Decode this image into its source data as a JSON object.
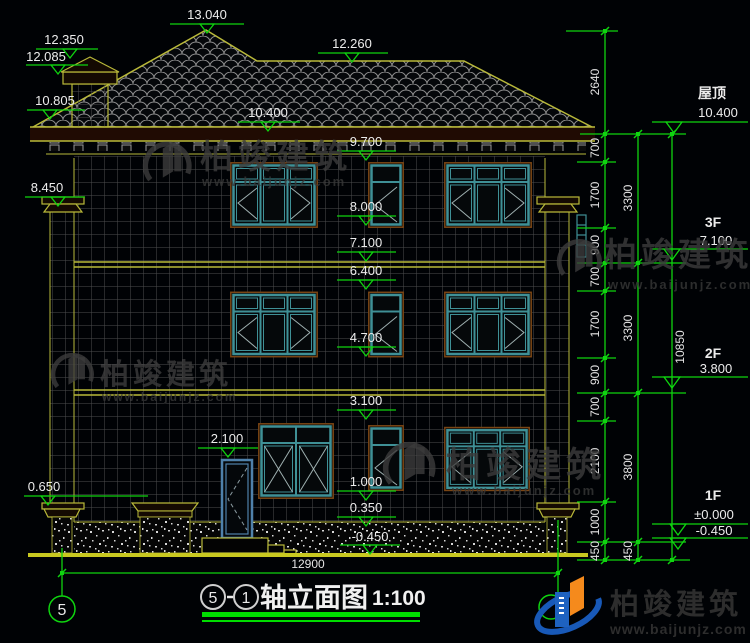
{
  "drawing": {
    "levels": {
      "ridge": "13.040",
      "chimney_top": "12.350",
      "chimney_band": "12.085",
      "roof_right": "12.260",
      "eave_left": "10.805",
      "eave": "10.400",
      "w3_head": "9.700",
      "pilaster_cap": "8.450",
      "w3_sill": "8.000",
      "f3": "7.100",
      "w2_head": "6.400",
      "w2_sill": "4.700",
      "w1_head": "3.100",
      "door_head": "2.100",
      "w1_sill": "1.000",
      "base_left": "0.650",
      "plinth_top": "0.350",
      "ground": "-0.450"
    },
    "right_markers": {
      "roof_label": "屋顶",
      "roof_value": "10.400",
      "f3_label": "3F",
      "f3_value": "7.100",
      "f2_label": "2F",
      "f2_value": "3.800",
      "f1_label": "1F",
      "f1_value": "±0.000",
      "ground_value": "-0.450"
    },
    "dims": {
      "right_inner": [
        "2640",
        "700",
        "1700",
        "900",
        "700",
        "1700",
        "900",
        "700",
        "2100",
        "1000",
        "450"
      ],
      "right_outer": [
        "3300",
        "3300",
        "3800",
        "450"
      ],
      "right_total": "10850",
      "overall_width": "12900"
    },
    "axes": {
      "left": "5",
      "right": "1"
    },
    "title": {
      "axis_start": "5",
      "axis_end": "1",
      "name": "轴立面图",
      "scale": "1:100"
    }
  },
  "watermark": {
    "name": "柏竣建筑",
    "url": "www.baijunjz.com"
  },
  "brand": {
    "name": "柏竣建筑",
    "url": "www.baijunjz.com"
  }
}
